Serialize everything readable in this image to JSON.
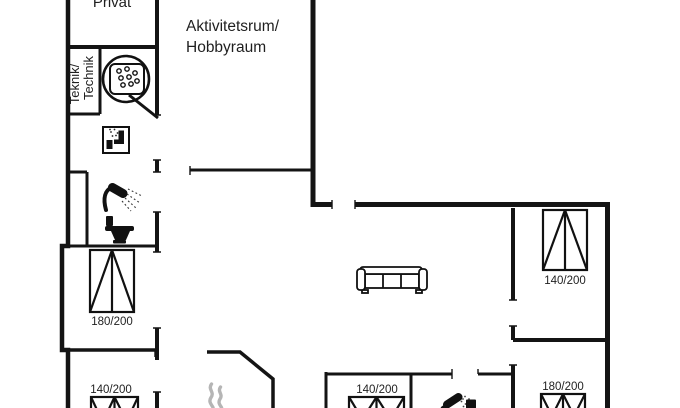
{
  "plan": {
    "rooms": {
      "privat_label": "Privat",
      "activity_label_line1": "Aktivitetsrum/",
      "activity_label_line2": "Hobbyraum",
      "technik_label_line1": "Teknik/",
      "technik_label_line2": "Technik"
    },
    "bed_labels": [
      {
        "location": "left-middle-bedroom",
        "label": "180/200"
      },
      {
        "location": "left-bottom-bedroom",
        "label": "140/200"
      },
      {
        "location": "center-bottom-bedroom",
        "label": "140/200"
      },
      {
        "location": "right-top-bedroom",
        "label": "140/200"
      },
      {
        "location": "right-bottom-bedroom",
        "label": "180/200"
      }
    ],
    "icons": [
      {
        "name": "hot-tub"
      },
      {
        "name": "washing-machine"
      },
      {
        "name": "shower"
      },
      {
        "name": "toilet"
      },
      {
        "name": "sofa"
      },
      {
        "name": "fireplace-flame"
      },
      {
        "name": "shower"
      },
      {
        "name": "toilet"
      }
    ],
    "colors": {
      "wall": "#141414",
      "text": "#1f1f1f",
      "flame": "#b5b5b5",
      "background": "#ffffff"
    }
  }
}
